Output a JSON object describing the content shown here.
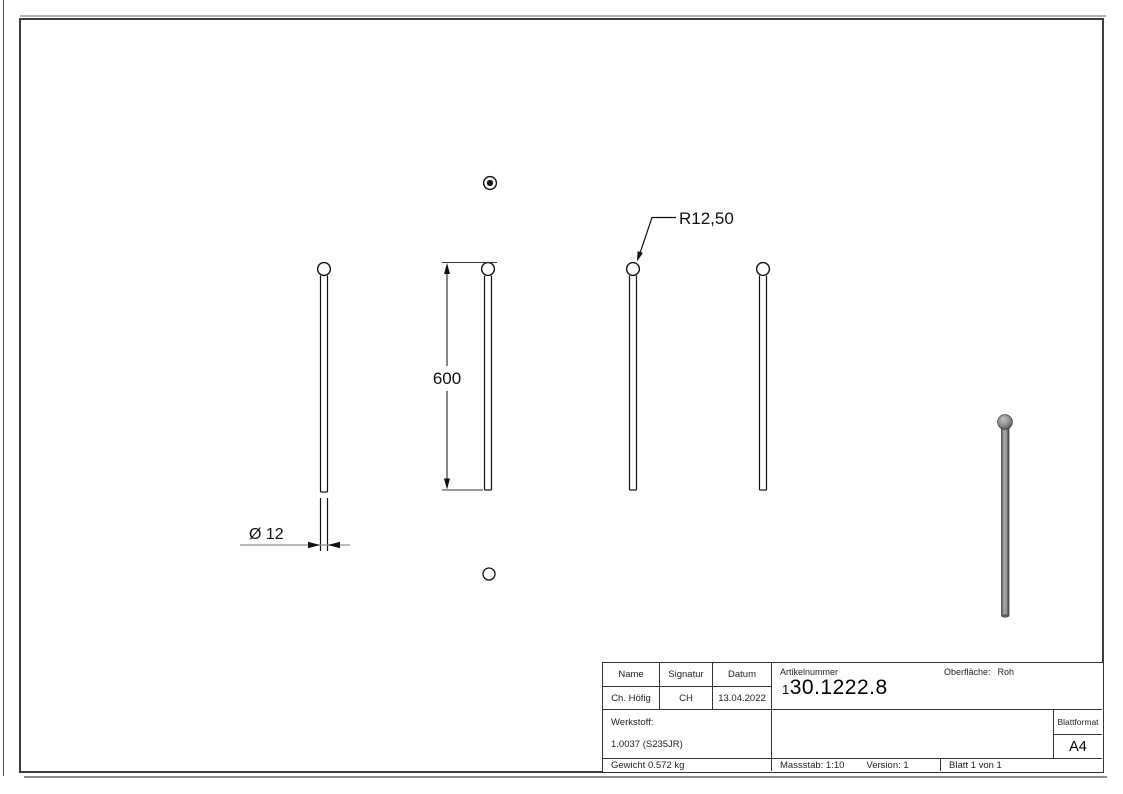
{
  "annotations": {
    "radius": "R12,50",
    "length": "600",
    "diameter": "Ø 12"
  },
  "title_block": {
    "col_name": "Name",
    "col_signatur": "Signatur",
    "col_datum": "Datum",
    "val_name": "Ch. Höfig",
    "val_signatur": "CH",
    "val_datum": "13.04.2022",
    "artikelnummer_label": "Artikelnummer",
    "artikelnummer_prefix": "1",
    "artikelnummer_value": "30.1222.8",
    "oberflaeche_label": "Oberfläche:",
    "oberflaeche_value": "Roh",
    "werkstoff_label": "Werkstoff:",
    "werkstoff_value": "1.0037 (S235JR)",
    "blattformat_label": "Blattformat",
    "blattformat_value": "A4",
    "gewicht": "Gewicht 0.572 kg",
    "massstab": "Massstab: 1:10",
    "version": "Version: 1",
    "blatt": "Blatt 1 von 1"
  },
  "colors": {
    "drawing_line": "#1a1a1a",
    "dim_leader_gray": "#8f8f8f",
    "frame": "#3d3d3d",
    "steel_light": "#b0b0b0",
    "steel_dark": "#4a4a4a"
  }
}
